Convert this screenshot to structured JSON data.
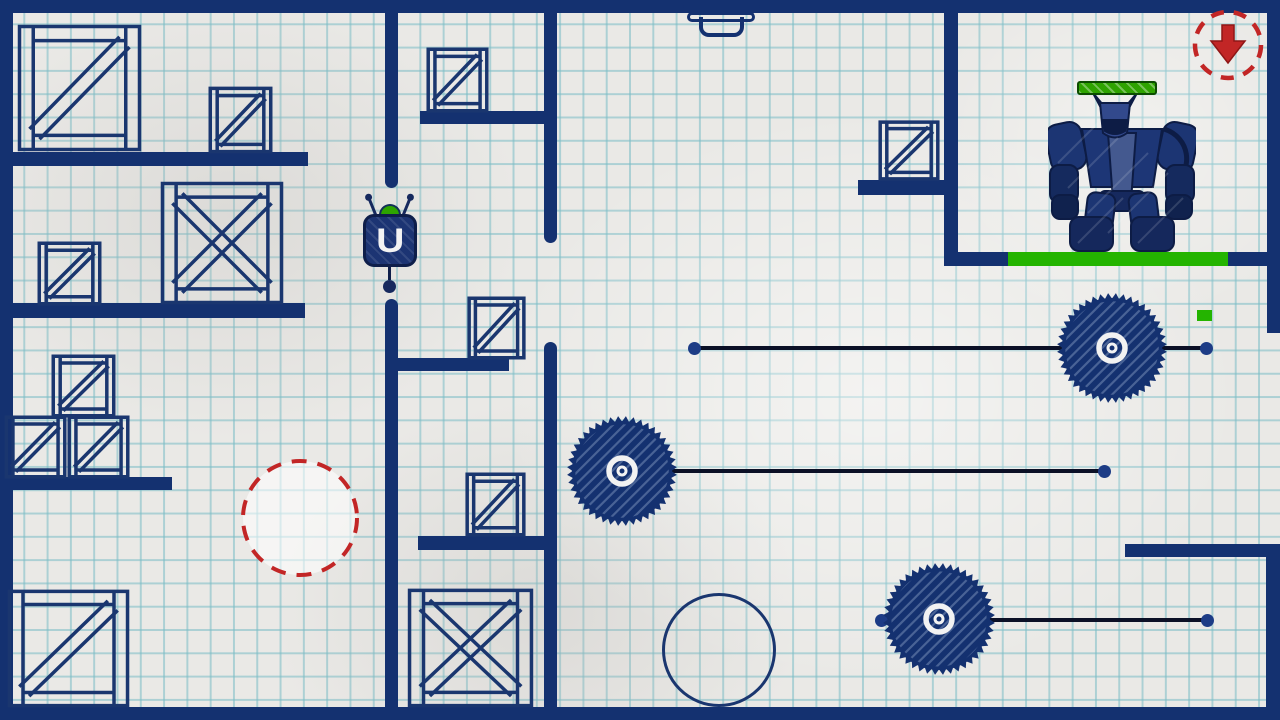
{
  "scene": {
    "width": 1280,
    "height": 720,
    "colors": {
      "paper": "#eae9e6",
      "grid": "#79bcc5",
      "wall": "#143170",
      "crate": "#1a366f",
      "ink": "#0e1e4a",
      "rail": "#0b1026",
      "rail_dot": "#1d3c86",
      "green": "#24b400",
      "health_green": "#2ea300",
      "health_border": "#0b4d00",
      "red": "#c22626",
      "white": "#f2f2f2"
    }
  },
  "walls": [
    {
      "x": 0,
      "y": 0,
      "w": 1280,
      "h": 13
    },
    {
      "x": 0,
      "y": 707,
      "w": 1280,
      "h": 13
    },
    {
      "x": 0,
      "y": 0,
      "w": 13,
      "h": 720
    },
    {
      "x": 1267,
      "y": 0,
      "w": 13,
      "h": 333
    },
    {
      "x": 1125,
      "y": 544,
      "w": 155,
      "h": 13
    },
    {
      "x": 1266,
      "y": 544,
      "w": 14,
      "h": 176
    },
    {
      "x": 0,
      "y": 152,
      "w": 308,
      "h": 14
    },
    {
      "x": 0,
      "y": 303,
      "w": 305,
      "h": 15
    },
    {
      "x": 0,
      "y": 477,
      "w": 172,
      "h": 13
    },
    {
      "x": 385,
      "y": 0,
      "w": 13,
      "h": 188,
      "br": "0 0 7px 7px"
    },
    {
      "x": 385,
      "y": 299,
      "w": 13,
      "h": 421,
      "br": "7px 7px 0 0"
    },
    {
      "x": 544,
      "y": 0,
      "w": 13,
      "h": 243,
      "br": "0 0 7px 7px"
    },
    {
      "x": 544,
      "y": 342,
      "w": 13,
      "h": 378,
      "br": "7px 7px 0 0"
    },
    {
      "x": 420,
      "y": 111,
      "w": 137,
      "h": 13
    },
    {
      "x": 395,
      "y": 358,
      "w": 114,
      "h": 13
    },
    {
      "x": 418,
      "y": 536,
      "w": 139,
      "h": 14
    },
    {
      "x": 944,
      "y": 0,
      "w": 14,
      "h": 266
    },
    {
      "x": 944,
      "y": 252,
      "w": 64,
      "h": 14
    },
    {
      "x": 1228,
      "y": 252,
      "w": 52,
      "h": 14
    },
    {
      "x": 858,
      "y": 180,
      "w": 100,
      "h": 15
    }
  ],
  "green_platforms": [
    {
      "x": 1008,
      "y": 252,
      "w": 220,
      "h": 14
    },
    {
      "x": 1197,
      "y": 310,
      "w": 15,
      "h": 11
    }
  ],
  "crates": [
    {
      "x": 17,
      "y": 24,
      "w": 125,
      "h": 128,
      "style": "z"
    },
    {
      "x": 209,
      "y": 87,
      "w": 63,
      "h": 66,
      "style": "z"
    },
    {
      "x": 160,
      "y": 181,
      "w": 124,
      "h": 124,
      "style": "x"
    },
    {
      "x": 38,
      "y": 242,
      "w": 63,
      "h": 63,
      "style": "z"
    },
    {
      "x": 52,
      "y": 355,
      "w": 63,
      "h": 62,
      "style": "z"
    },
    {
      "x": 5,
      "y": 416,
      "w": 61,
      "h": 62,
      "style": "z"
    },
    {
      "x": 68,
      "y": 416,
      "w": 61,
      "h": 62,
      "style": "z"
    },
    {
      "x": 7,
      "y": 589,
      "w": 123,
      "h": 119,
      "style": "z"
    },
    {
      "x": 427,
      "y": 48,
      "w": 61,
      "h": 64,
      "style": "z"
    },
    {
      "x": 468,
      "y": 297,
      "w": 57,
      "h": 62,
      "style": "z"
    },
    {
      "x": 466,
      "y": 473,
      "w": 59,
      "h": 63,
      "style": "z"
    },
    {
      "x": 407,
      "y": 588,
      "w": 127,
      "h": 120,
      "style": "x"
    },
    {
      "x": 879,
      "y": 121,
      "w": 60,
      "h": 59,
      "style": "z"
    }
  ],
  "rails": [
    {
      "x1": 694,
      "x2": 1206,
      "y": 348
    },
    {
      "x1": 620,
      "x2": 1104,
      "y": 471
    },
    {
      "x1": 881,
      "x2": 1207,
      "y": 620
    }
  ],
  "saws": [
    {
      "cx": 1112,
      "cy": 348,
      "r": 55
    },
    {
      "cx": 622,
      "cy": 471,
      "r": 55
    },
    {
      "cx": 939,
      "cy": 619,
      "r": 56
    }
  ],
  "sketch_circles": [
    {
      "cx": 719,
      "cy": 650,
      "r": 57
    }
  ],
  "teleport_marker": {
    "cx": 300,
    "cy": 518,
    "r": 57
  },
  "exit_marker": {
    "cx": 1228,
    "cy": 45,
    "r": 33,
    "arrow": "down"
  },
  "claw": {
    "x": 683,
    "y": 0
  },
  "player": {
    "x": 355,
    "y": 196,
    "symbol": "U",
    "dome_color": "#2da400"
  },
  "robot": {
    "x": 1048,
    "y": 93,
    "w": 148,
    "h": 160,
    "health_bar": {
      "x": 1077,
      "y": 81,
      "w": 80,
      "h": 14,
      "fill": 1
    }
  }
}
